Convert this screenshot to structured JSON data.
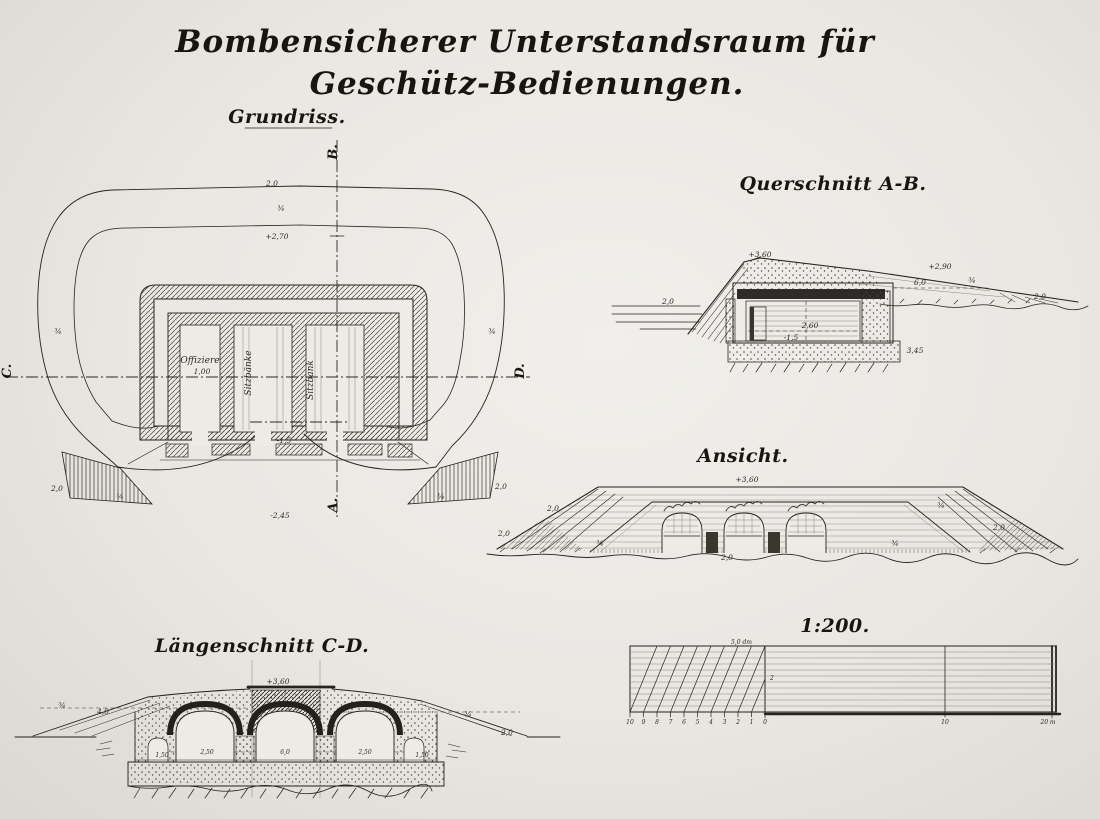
{
  "title": {
    "line1": "Bombensicherer Unterstandsraum für",
    "line2": "Geschütz-Bedienungen."
  },
  "views": {
    "plan": {
      "label": "Grundriss.",
      "axis": {
        "top": "B.",
        "bottom": "A.",
        "left": "C.",
        "right": "D."
      },
      "rooms": [
        {
          "label": "Offiziere"
        },
        {
          "label": "Sitzbänke"
        },
        {
          "label": "Sitzbank"
        }
      ],
      "dims": {
        "top_width": "2,0",
        "slope_top": "¾",
        "crest": "+2,70",
        "slope_left": "¾",
        "slope_right": "¾",
        "room_width": "1,00",
        "sole": "-1,5",
        "floor": "-2,45",
        "wing_left_h": "2,0",
        "wing_left_slope": "¼",
        "wing_right_slope": "¼",
        "wing_right_h": "2,0"
      }
    },
    "cross": {
      "label": "Querschnitt A-B.",
      "dims": {
        "crest": "+3,60",
        "shoulder": "+2,90",
        "width": "6,0",
        "slope": "¾",
        "ground_left": "2,0",
        "ground_right": "2,0",
        "room_height": "2,60",
        "floor": "-1,5",
        "foundation": "3,45"
      }
    },
    "elevation": {
      "label": "Ansicht.",
      "dims": {
        "crest": "+3,60",
        "ground_left": "2,0",
        "slope_left_top": "2,0",
        "slope_left": "¾",
        "slope_right": "¾",
        "slope_right_low": "¾",
        "slope_right_bottom": "2,0",
        "base": "2,0"
      }
    },
    "long": {
      "label": "Längenschnitt C-D.",
      "dims": {
        "crest": "+3,60",
        "slope_left": "¾",
        "berm_left": "4,0",
        "slope_right": "¾",
        "ground_right": "2,0",
        "floor_dims": [
          "1,50",
          "2,50",
          "6,0",
          "2,50",
          "1,50"
        ]
      }
    },
    "scale": {
      "label": "1:200.",
      "unit": "5,0 dm",
      "row": "2",
      "ticks_left": [
        "10",
        "9",
        "8",
        "7",
        "6",
        "5",
        "4",
        "3",
        "2",
        "1",
        "0"
      ],
      "tick_mid": "10",
      "tick_end": "20 m"
    }
  },
  "colors": {
    "paper": "#e9e7e2",
    "ink": "#1e1c19"
  }
}
